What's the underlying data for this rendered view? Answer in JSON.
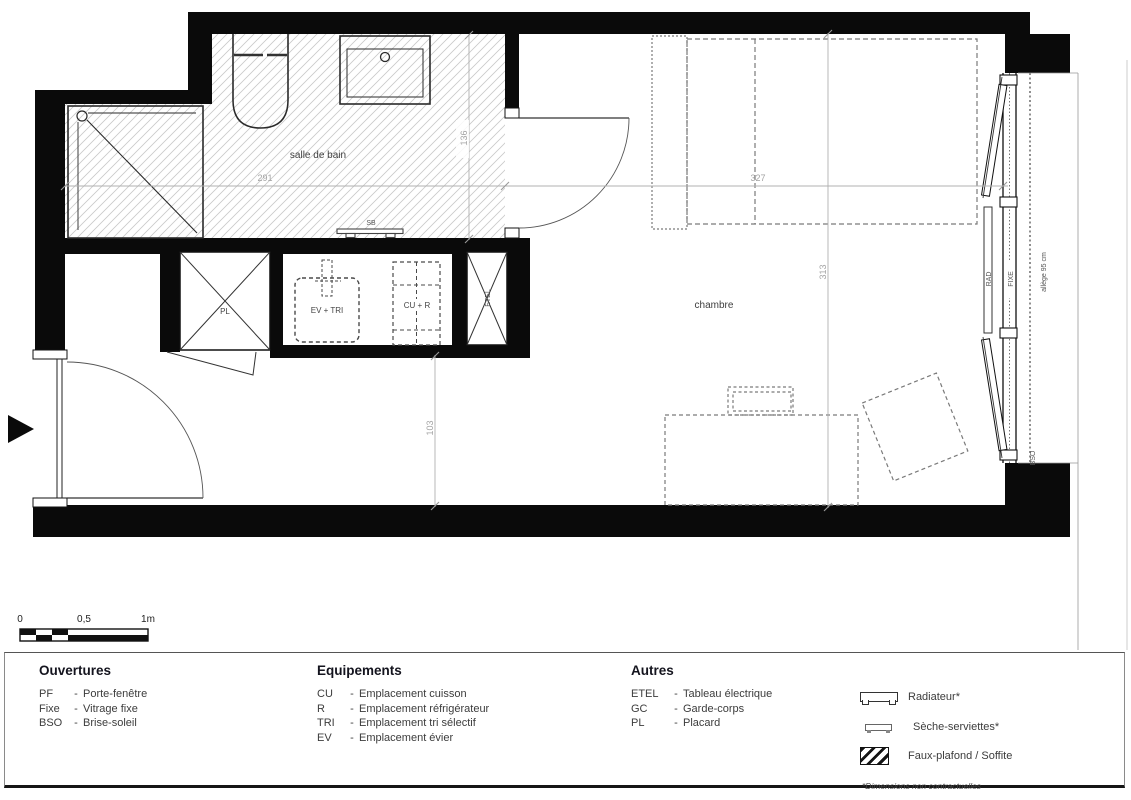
{
  "plan": {
    "room_labels": {
      "bathroom": "salle de bain",
      "bedroom": "chambre"
    },
    "equipment_labels": {
      "sb": "SB",
      "pl": "PL",
      "ev_tri": "EV + TRI",
      "cu_r": "CU + R",
      "etel": "ETEL",
      "rad": "RAD",
      "fixe": "FIXE",
      "allege": "allège 95 cm",
      "bso": "BSO"
    },
    "dimensions": {
      "bathroom_width": "291",
      "bathroom_depth": "136",
      "bedroom_width": "327",
      "bedroom_depth": "313",
      "hallway_width": "103"
    }
  },
  "scale_bar": {
    "zero": "0",
    "half": "0,5",
    "one": "1m"
  },
  "legend": {
    "sep": "-",
    "openings": {
      "title": "Ouvertures",
      "items": [
        {
          "abbr": "PF",
          "label": "Porte-fenêtre"
        },
        {
          "abbr": "Fixe",
          "label": "Vitrage fixe"
        },
        {
          "abbr": "BSO",
          "label": "Brise-soleil"
        }
      ]
    },
    "equipment": {
      "title": "Equipements",
      "items": [
        {
          "abbr": "CU",
          "label": "Emplacement cuisson"
        },
        {
          "abbr": "R",
          "label": "Emplacement réfrigérateur"
        },
        {
          "abbr": "TRI",
          "label": "Emplacement tri sélectif"
        },
        {
          "abbr": "EV",
          "label": "Emplacement évier"
        }
      ]
    },
    "others": {
      "title": "Autres",
      "items": [
        {
          "abbr": "ETEL",
          "label": "Tableau électrique"
        },
        {
          "abbr": "GC",
          "label": "Garde-corps"
        },
        {
          "abbr": "PL",
          "label": "Placard"
        }
      ]
    },
    "symbols": {
      "radiator": "Radiateur*",
      "towel_dryer": "Sèche-serviettes*",
      "false_ceiling": "Faux-plafond / Soffite"
    },
    "note": "*Dimensions non contractuelles"
  }
}
